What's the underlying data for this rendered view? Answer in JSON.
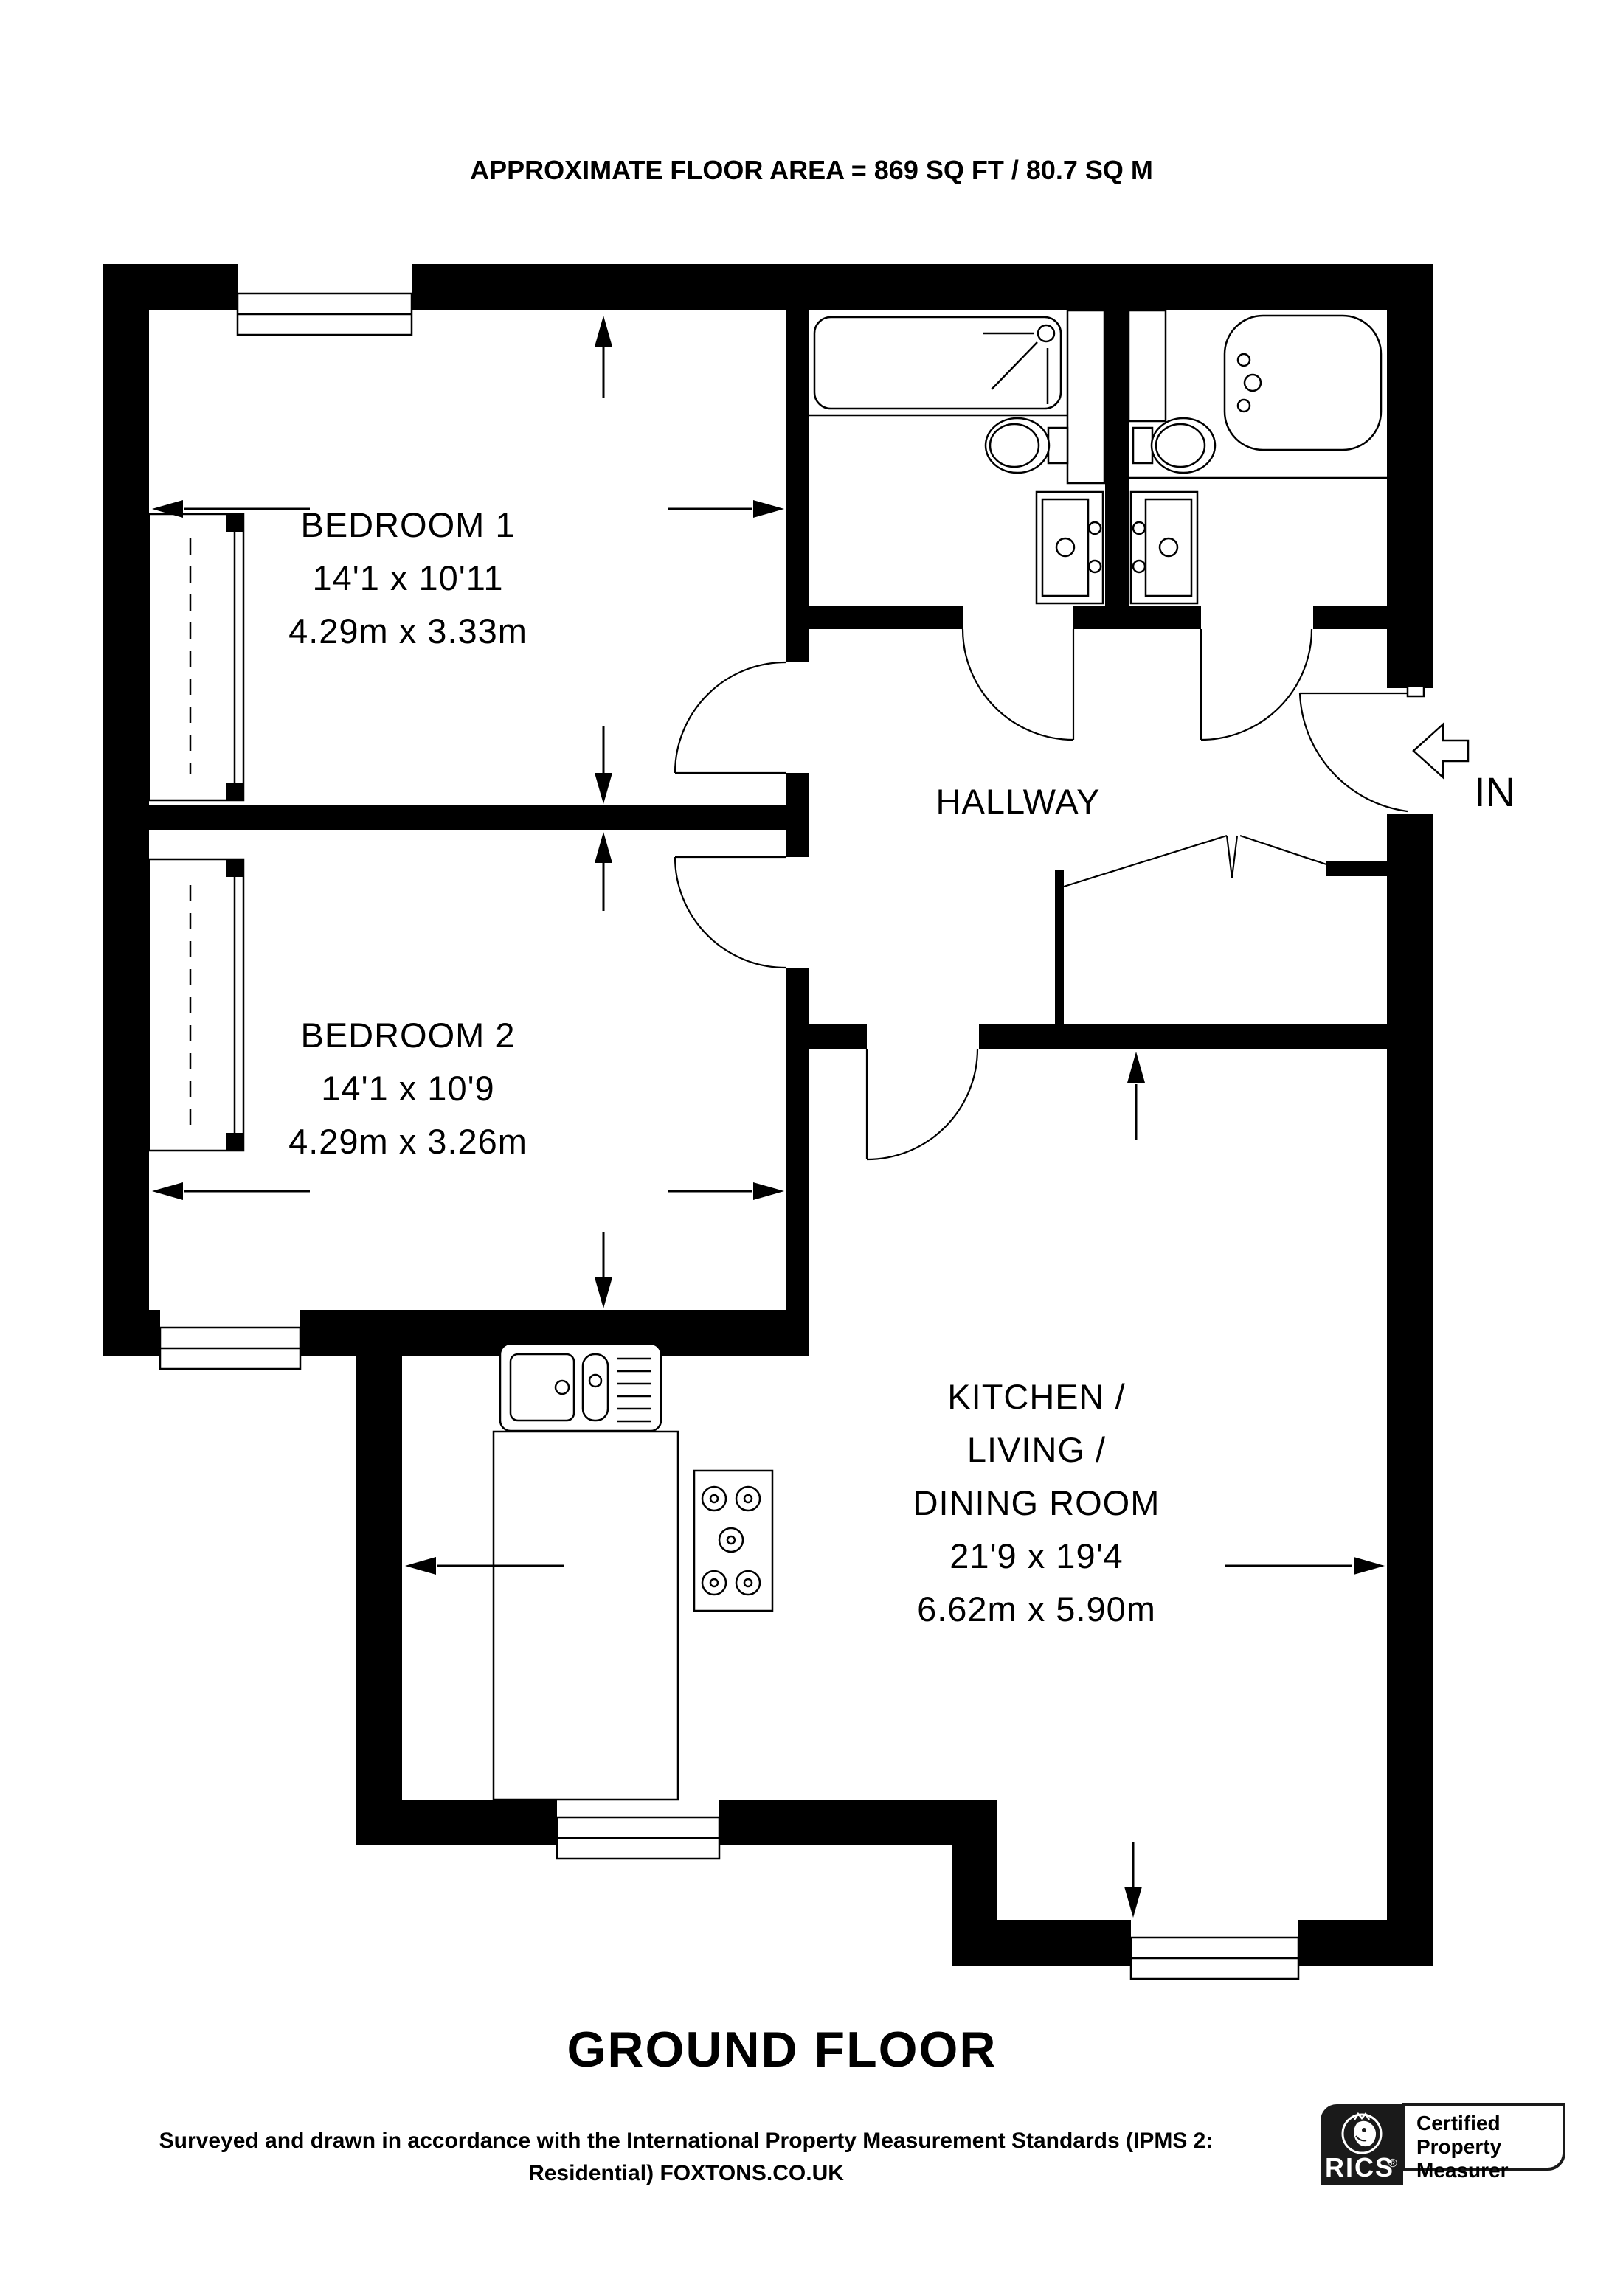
{
  "title": "APPROXIMATE FLOOR AREA = 869 SQ FT / 80.7 SQ M",
  "plan": {
    "floor_label": "GROUND FLOOR",
    "entrance_label": "IN",
    "rooms": {
      "bedroom1": {
        "name": "BEDROOM 1",
        "dims_imperial": "14'1 x 10'11",
        "dims_metric": "4.29m x 3.33m"
      },
      "bedroom2": {
        "name": "BEDROOM 2",
        "dims_imperial": "14'1 x 10'9",
        "dims_metric": "4.29m x 3.26m"
      },
      "hallway": {
        "name": "HALLWAY"
      },
      "kitchen_living_dining": {
        "name_line1": "KITCHEN /",
        "name_line2": "LIVING /",
        "name_line3": "DINING ROOM",
        "dims_imperial": "21'9 x 19'4",
        "dims_metric": "6.62m x 5.90m"
      }
    },
    "fixture_icons": [
      "shower-bath-icon",
      "bathtub-icon",
      "toilet-icon",
      "basin-vanity-icon",
      "kitchen-sink-icon",
      "hob-icon",
      "wardrobe-icon",
      "window-icon",
      "door-arc-icon",
      "double-door-icon",
      "entry-arrow-icon",
      "dimension-arrow-icon"
    ]
  },
  "footer": {
    "line1": "Surveyed and drawn in accordance with the International Property Measurement Standards (IPMS 2:",
    "line2": "Residential) FOXTONS.CO.UK"
  },
  "badge": {
    "brand": "RICS",
    "registered_mark": "®",
    "cert_line1": "Certified",
    "cert_line2": "Property",
    "cert_line3": "Measurer"
  },
  "colors": {
    "wall": "#000000",
    "line": "#000000",
    "background": "#ffffff"
  }
}
